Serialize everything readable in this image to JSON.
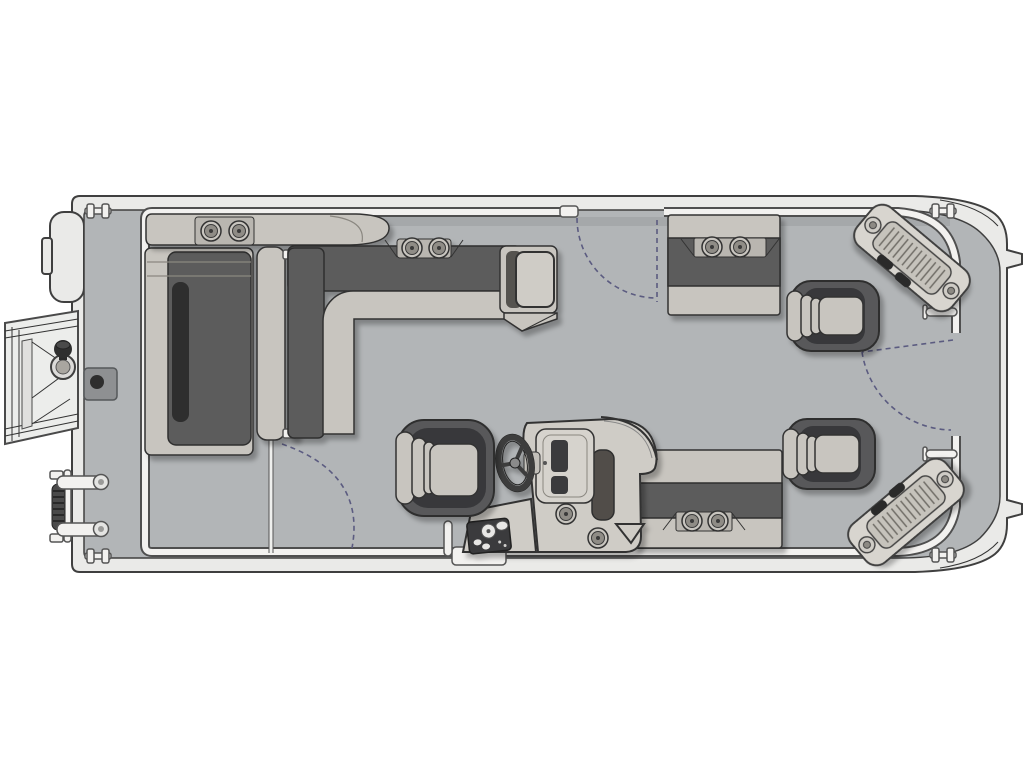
{
  "diagram": {
    "kind": "pontoon-boat-floorplan-top-view",
    "orientation": "horizontal",
    "visible_text": []
  },
  "colors": {
    "background": "#ffffff",
    "hull": "#eaeae8",
    "hull_stroke": "#3f3f3f",
    "deck": "#b2b5b7",
    "fence_casing": "#4f4f4f",
    "fence_fill": "#f2f1ef",
    "furniture_light": "#c8c5bf",
    "furniture_light2": "#cfccc6",
    "furniture_mid": "#b9b6b0",
    "cushion_dark": "#5c5c5c",
    "cushion_darker": "#2d2d2d",
    "outline_dark": "#2f2f2f",
    "outline_mid": "#333333",
    "chair_body": "#58595a",
    "chair_inner": "#38393b",
    "hardware_dark": "#2b2b2b",
    "door_arc": "#5b5b80",
    "cup_inner": "#8f8c86",
    "panel_screen": "#3a3a3c",
    "gauge_panel": "#3a3a3c",
    "plate_gray": "#8e9092"
  },
  "parts": {
    "cup_holder_count": 10,
    "captain_chair_count": 3,
    "cleat_count": 4,
    "corner_step_pad_count": 2,
    "door_swing_count": 3,
    "has_steering_wheel": true,
    "has_boarding_ladder": true,
    "has_gangway_ramp": true,
    "has_helm_console": true,
    "lounge_count": 2,
    "bench_count": 2
  }
}
